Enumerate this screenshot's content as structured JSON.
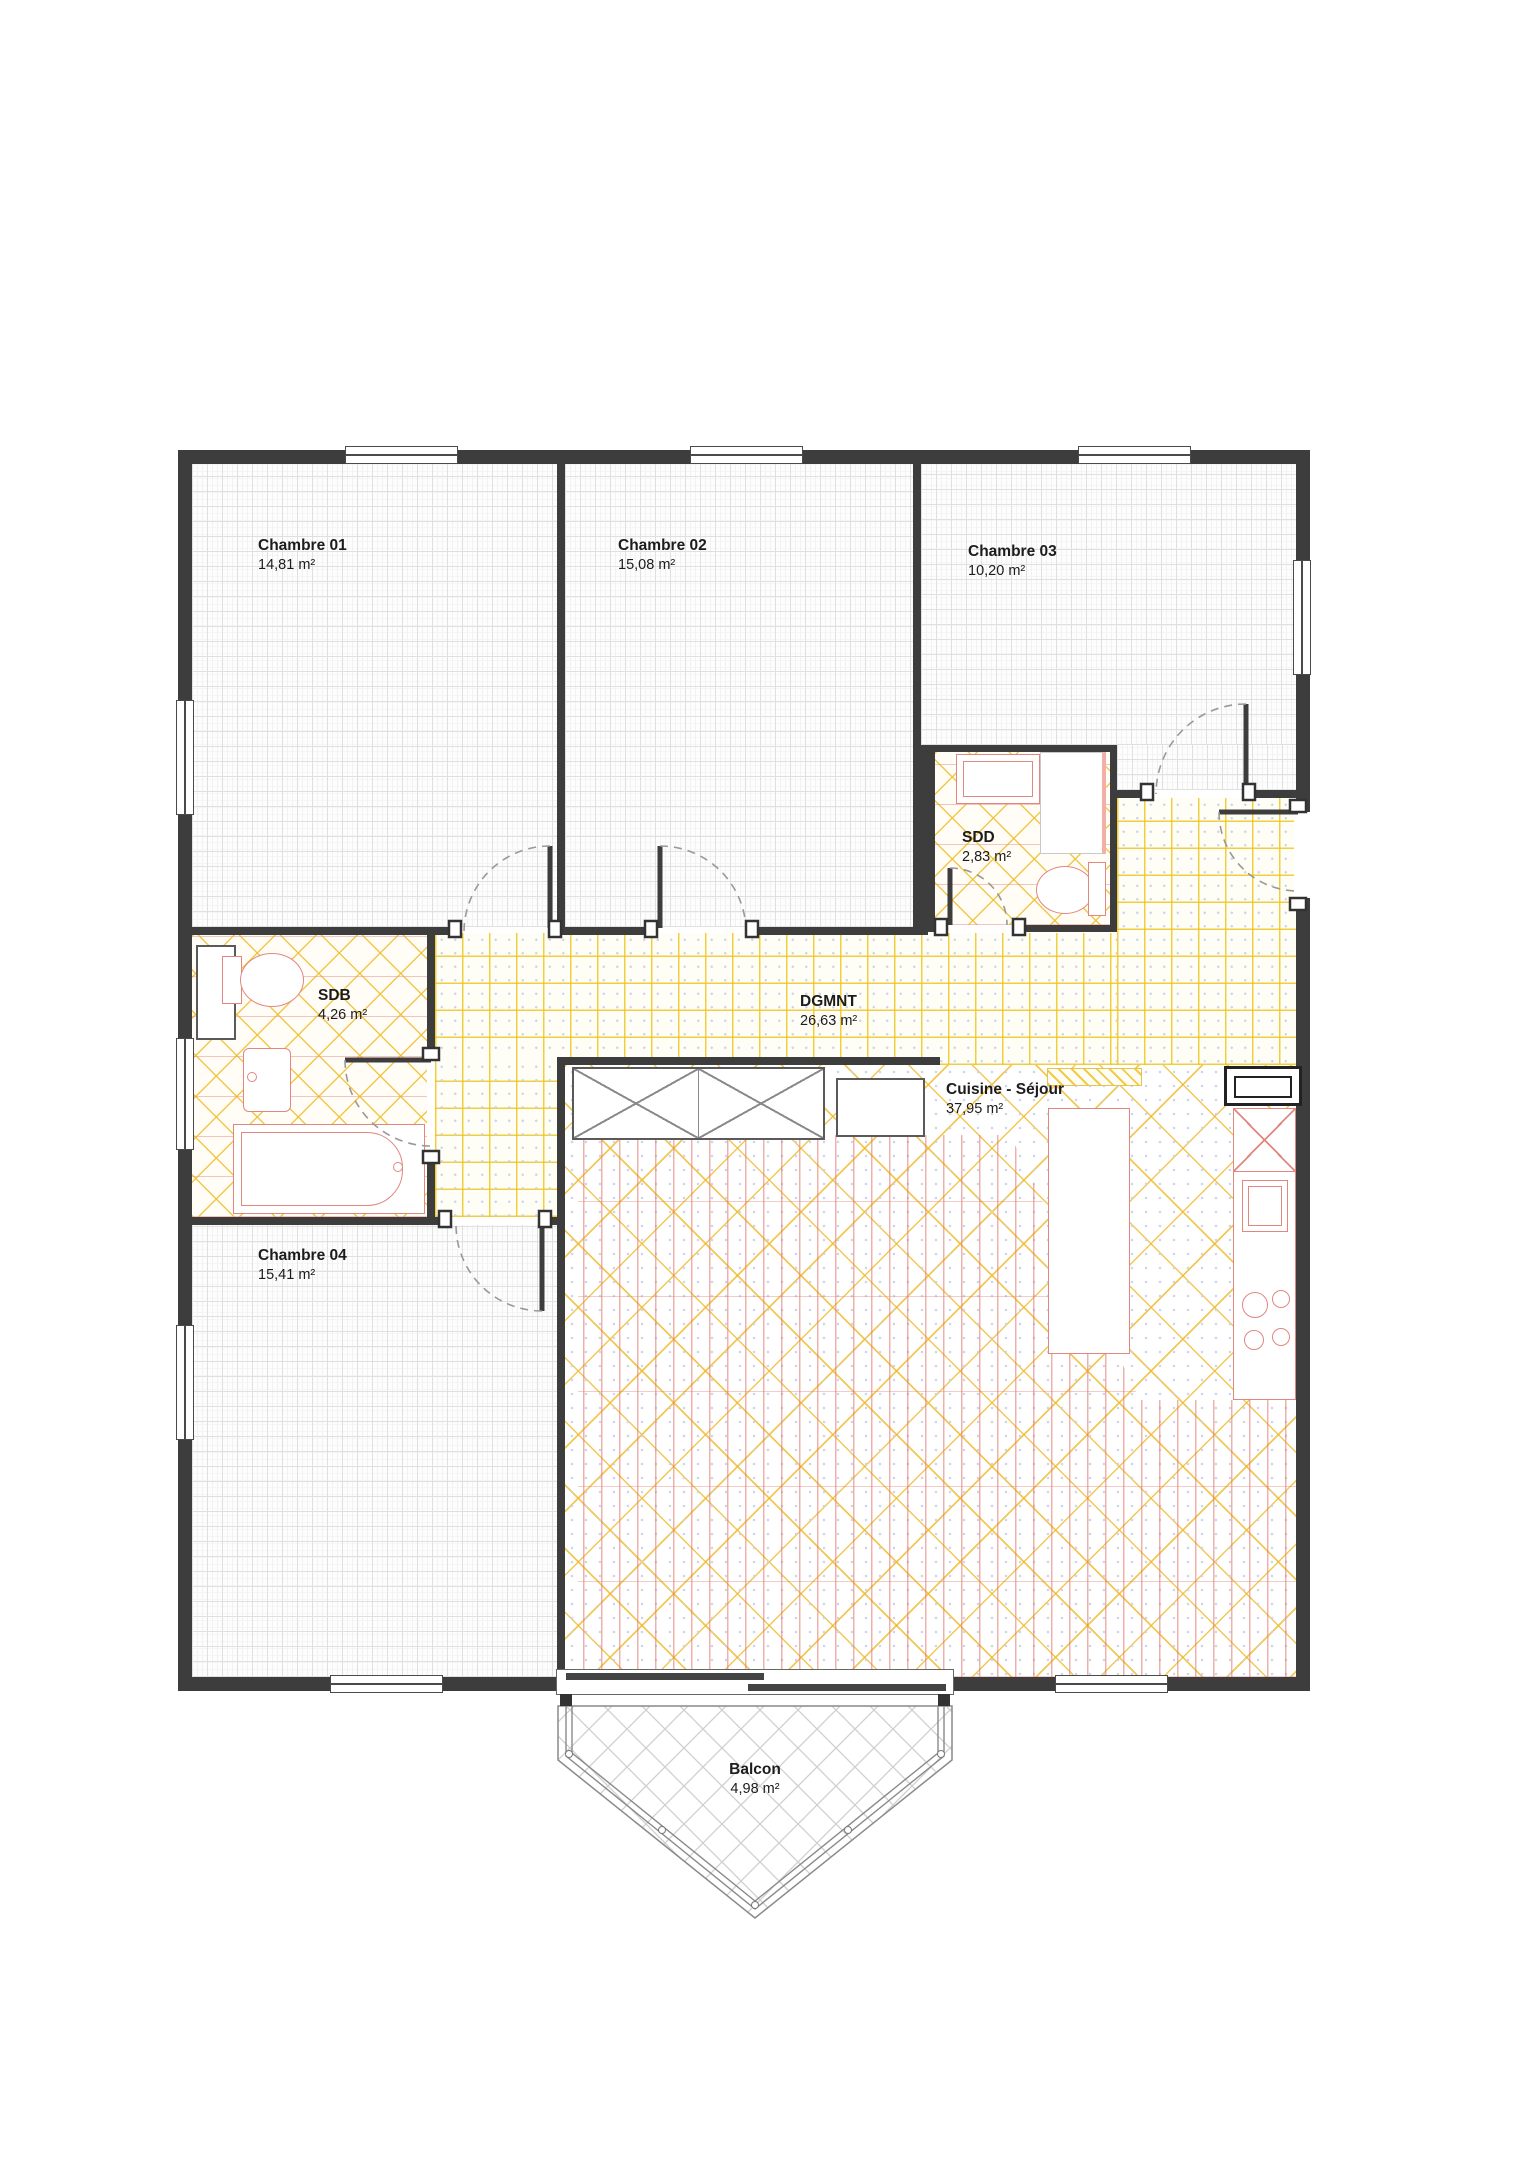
{
  "rooms": [
    {
      "id": "chambre-01",
      "name": "Chambre 01",
      "area": "14,81 m²"
    },
    {
      "id": "chambre-02",
      "name": "Chambre 02",
      "area": "15,08 m²"
    },
    {
      "id": "chambre-03",
      "name": "Chambre 03",
      "area": "10,20 m²"
    },
    {
      "id": "sdd",
      "name": "SDD",
      "area": "2,83 m²"
    },
    {
      "id": "sdb",
      "name": "SDB",
      "area": "4,26 m²"
    },
    {
      "id": "dgmnt",
      "name": "DGMNT",
      "area": "26,63 m²"
    },
    {
      "id": "cuisine-sejour",
      "name": "Cuisine - Séjour",
      "area": "37,95 m²"
    },
    {
      "id": "chambre-04",
      "name": "Chambre 04",
      "area": "15,41 m²"
    },
    {
      "id": "balcon",
      "name": "Balcon",
      "area": "4,98 m²"
    }
  ],
  "colors": {
    "wall": "#3d3d3d",
    "tile_line": "#eec520",
    "tile_dot": "#ccd4ea",
    "bath_hatch": "#f0be2d",
    "fixture": "#e08880",
    "plank": "#e27d73",
    "balcony_hatch": "#cfcfcf",
    "door_arc": "#999999"
  }
}
